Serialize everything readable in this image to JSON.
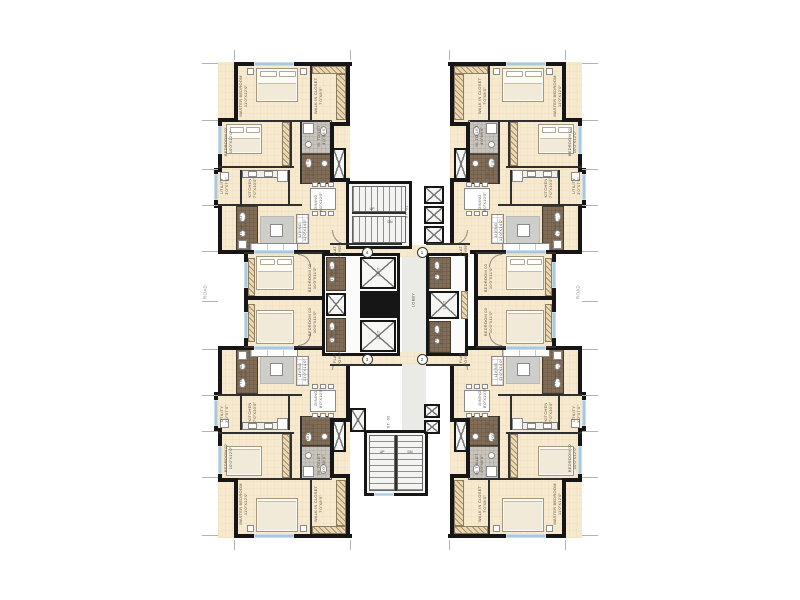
{
  "side_labels": {
    "left": "ROAD",
    "right": "ROAD"
  },
  "core": {
    "lobby": "LOBBY",
    "lift": "LIFT",
    "foyer": "FLAT\nFOYER",
    "toilet": "TOILET\n4'0\"X6'8\"",
    "stair_top": {
      "name": "ST- 01",
      "up": "UP",
      "dn": "DN"
    },
    "stair_bottom": {
      "name": "ST- 02",
      "up": "UP",
      "dn": "DN"
    },
    "flats": {
      "tl": "4",
      "tr": "1",
      "bl": "3",
      "br": "2"
    }
  },
  "unit_rooms": {
    "master": "MASTER BEDROOM\n11'0\"X12'0\"",
    "closet": "WALK IN CLOSET\n7'0\"X8'0\"",
    "m_toilet": "M. TOILET\n4'0\"X8'0\"",
    "toilet2": "TOILET 02\n4'0\"X7'0\"",
    "toilet3": "TOILET 03\n4'0\"X7'0\"",
    "bed2": "BEDROOM 02\n10'0\"X12'0\"",
    "bed3": "BEDROOM 03\n10'0\"X11'0\"",
    "kitchen": "KITCHEN\n7'0\"X10'0\"",
    "utility": "UTILITY\n3'0\"X7'0\"",
    "dining": "DINING\n8'0\"X10'0\"",
    "living": "LIVING\n11'0\"X14'0\""
  },
  "colors": {
    "wall": "#161616",
    "floor": "#f6e9cd",
    "bath_brown": "#806c57",
    "bath_gray": "#c9c5bd",
    "lobby": "#eaeae7",
    "window": "#a9c8dc",
    "hatch": "#ead9b4"
  }
}
